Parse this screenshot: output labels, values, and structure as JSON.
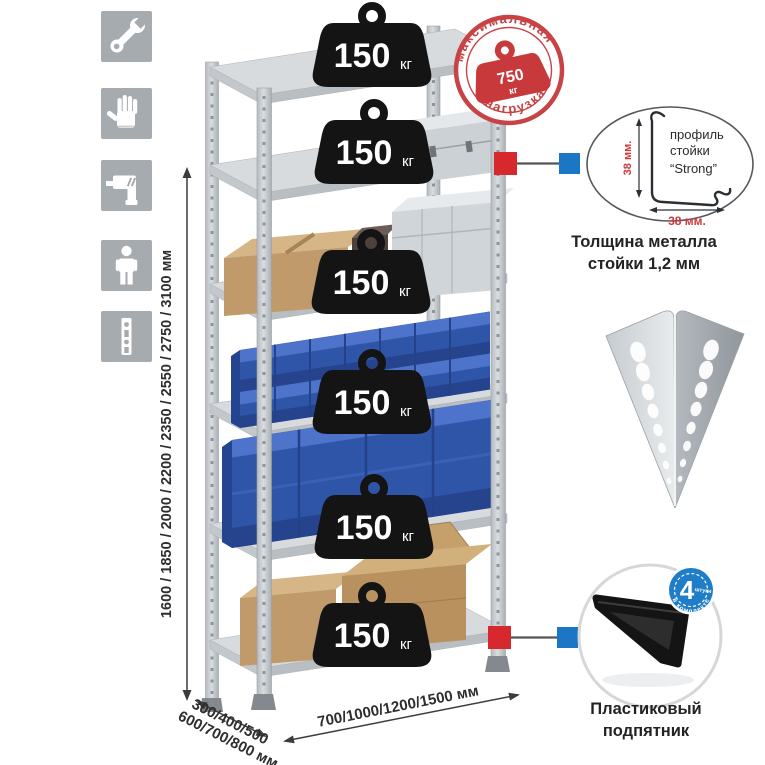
{
  "tools_panel": {
    "items": [
      {
        "icon": "wrench-icon"
      },
      {
        "icon": "gloves-icon"
      },
      {
        "icon": "drill-icon"
      },
      {
        "icon": "person-icon"
      },
      {
        "icon": "perforated-post-icon"
      }
    ]
  },
  "max_load_stamp": {
    "arc_top": "максимальная",
    "arc_bottom": "нагрузка",
    "value": "750",
    "unit": "кг"
  },
  "shelves": [
    {
      "load": "150",
      "unit": "кг"
    },
    {
      "load": "150",
      "unit": "кг"
    },
    {
      "load": "150",
      "unit": "кг"
    },
    {
      "load": "150",
      "unit": "кг"
    },
    {
      "load": "150",
      "unit": "кг"
    },
    {
      "load": "150",
      "unit": "кг"
    }
  ],
  "height_dimension": {
    "label": "1600 / 1850 / 2000 / 2200 / 2350 / 2550 / 2750 / 3100 мм"
  },
  "depth_dimension": {
    "line1": "300/400/500",
    "line2": "600/700/800 мм"
  },
  "width_dimension": {
    "label": "700/1000/1200/1500 мм"
  },
  "profile_detail": {
    "line1": "профиль",
    "line2": "стойки",
    "line3": "“Strong”",
    "dim_left": "38 мм.",
    "dim_bottom": "38 мм.",
    "caption1": "Толщина металла",
    "caption2": "стойки 1,2 мм"
  },
  "foot_detail": {
    "badge_value": "4",
    "badge_sub": "штуки",
    "badge_arc": "в комплекте",
    "caption1": "Пластиковый",
    "caption2": "подпятник"
  },
  "colors": {
    "accent_red": "#d7282e",
    "accent_blue": "#1b76c5",
    "stamp_red": "#c8393b",
    "bin_blue": "#2f55a8",
    "cardboard": "#c09a6a",
    "metal": "#ccd1d6",
    "tile_gray": "#a6abb0",
    "badge_black": "#141414"
  }
}
